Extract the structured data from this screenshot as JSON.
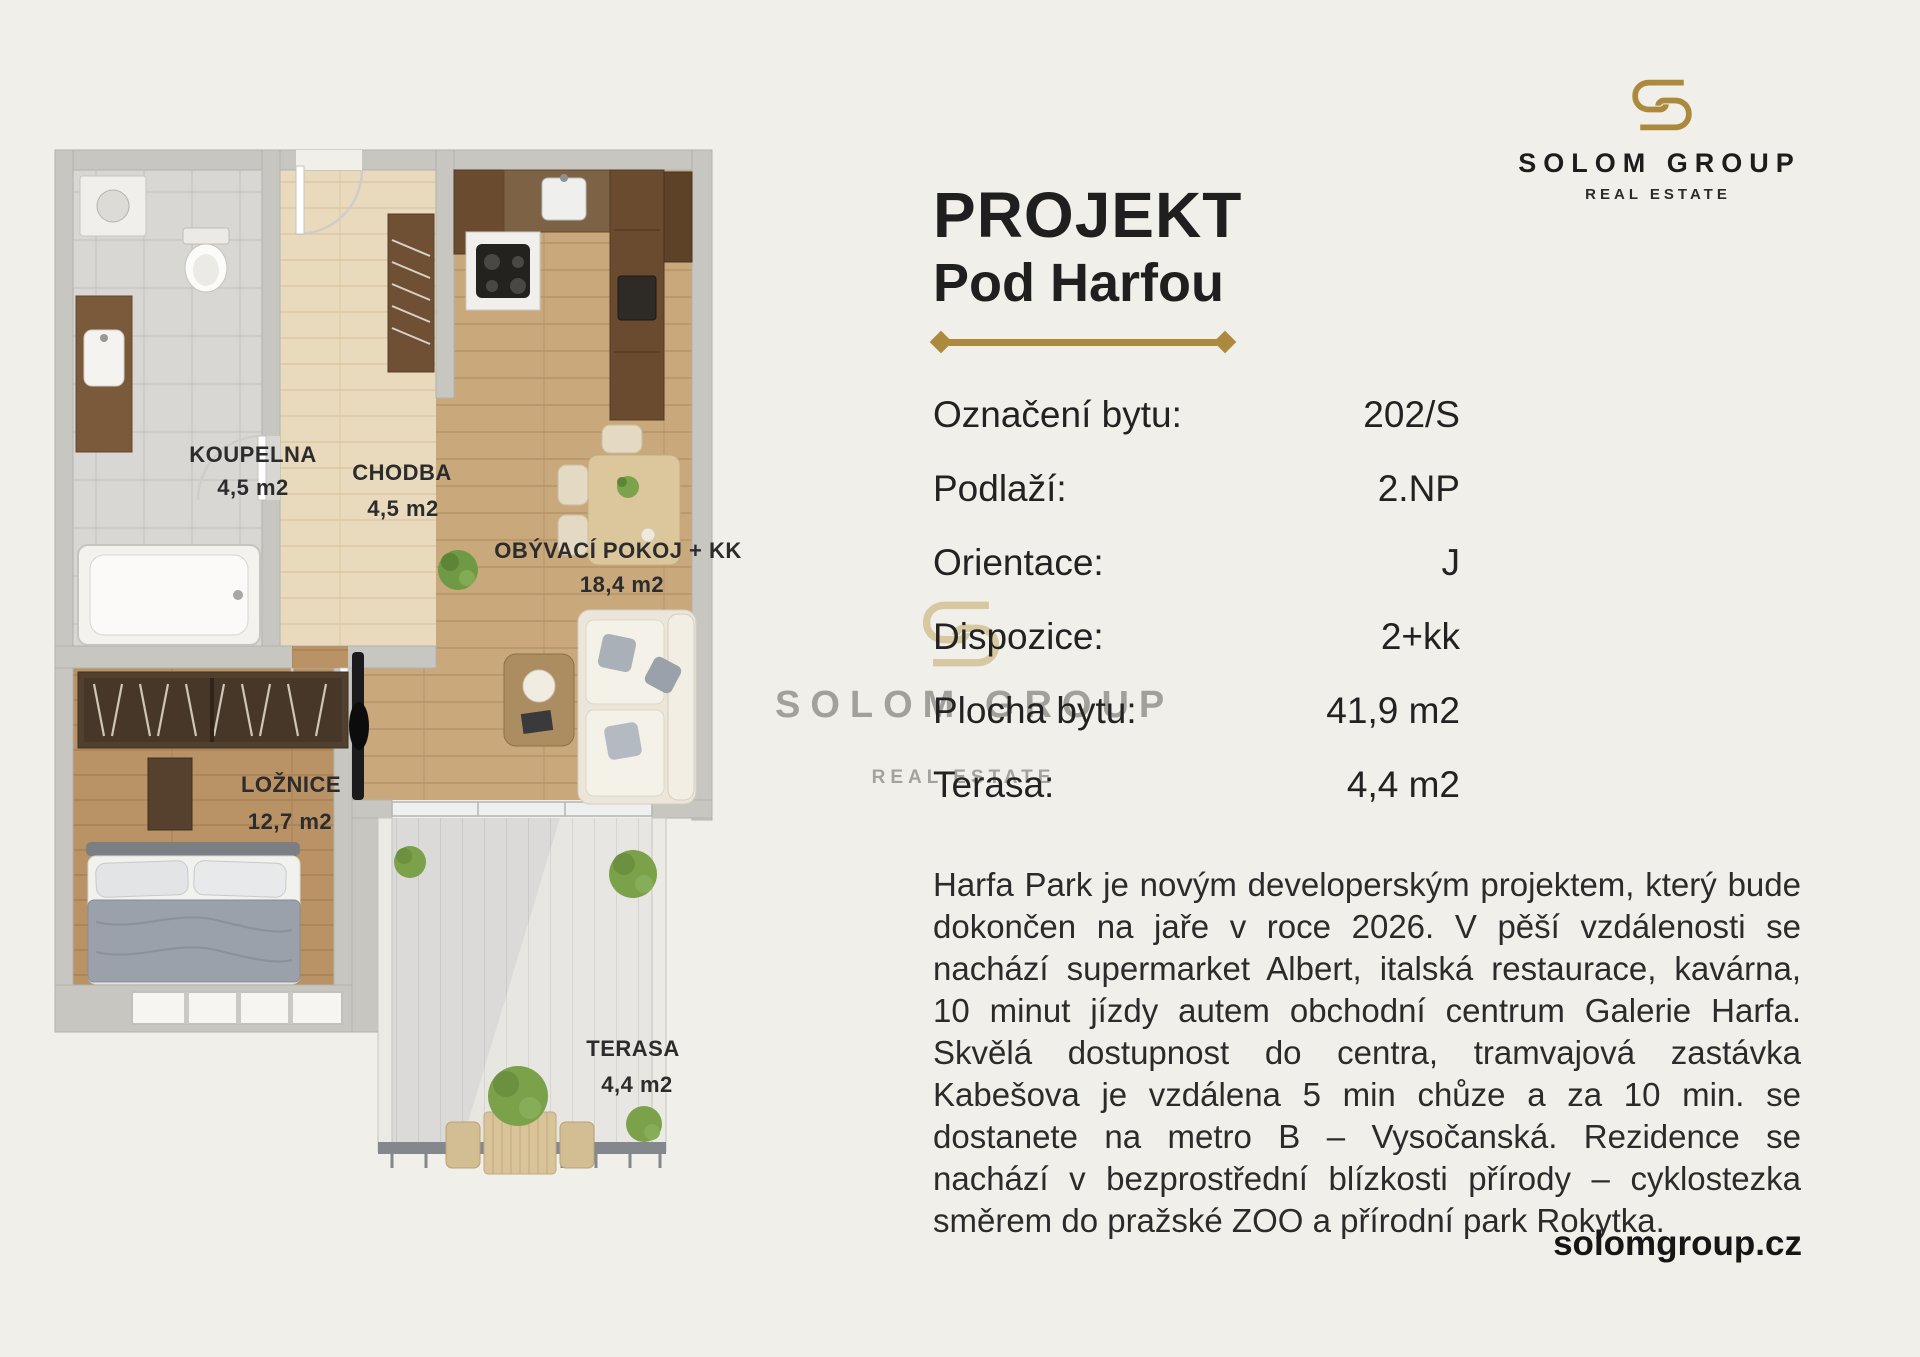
{
  "page": {
    "background": "#f1efe9",
    "accent_gold": "#ab8a3e",
    "website": "solomgroup.cz"
  },
  "logo": {
    "name": "SOLOM GROUP",
    "tagline": "REAL ESTATE"
  },
  "watermark": {
    "name": "SOLOM GROUP",
    "tagline": "REAL ESTATE"
  },
  "title": {
    "line1": "PROJEKT",
    "line2": "Pod Harfou"
  },
  "details": {
    "rows": [
      {
        "label": "Označení bytu:",
        "value": "202/S"
      },
      {
        "label": "Podlaží:",
        "value": "2.NP"
      },
      {
        "label": "Orientace:",
        "value": "J"
      },
      {
        "label": "Dispozice:",
        "value": "2+kk"
      },
      {
        "label": "Plocha bytu:",
        "value": "41,9 m2"
      },
      {
        "label": "Terasa:",
        "value": "4,4 m2"
      }
    ]
  },
  "description": "Harfa Park je novým developerským projektem, který bude dokončen na jaře v roce 2026. V pěší vzdálenosti se nachází supermarket Albert, italská restaurace, kavárna, 10 minut jízdy autem obchodní centrum Galerie Harfa. Skvělá dostupnost do centra, tramvajová zastávka Kabešova je vzdálena 5 min chůze a za 10 min. se dostanete na metro B – Vysočanská. Rezidence se nachází v bezprostřední blízkosti přírody – cyklostezka směrem do pražské ZOO a přírodní park Rokytka.",
  "floorplan": {
    "rooms": [
      {
        "name": "KOUPELNA",
        "area": "4,5 m2"
      },
      {
        "name": "CHODBA",
        "area": "4,5 m2"
      },
      {
        "name": "OBÝVACÍ POKOJ + KK",
        "area": "18,4 m2"
      },
      {
        "name": "LOŽNICE",
        "area": "12,7 m2"
      },
      {
        "name": "TERASA",
        "area": "4,4 m2"
      }
    ]
  }
}
